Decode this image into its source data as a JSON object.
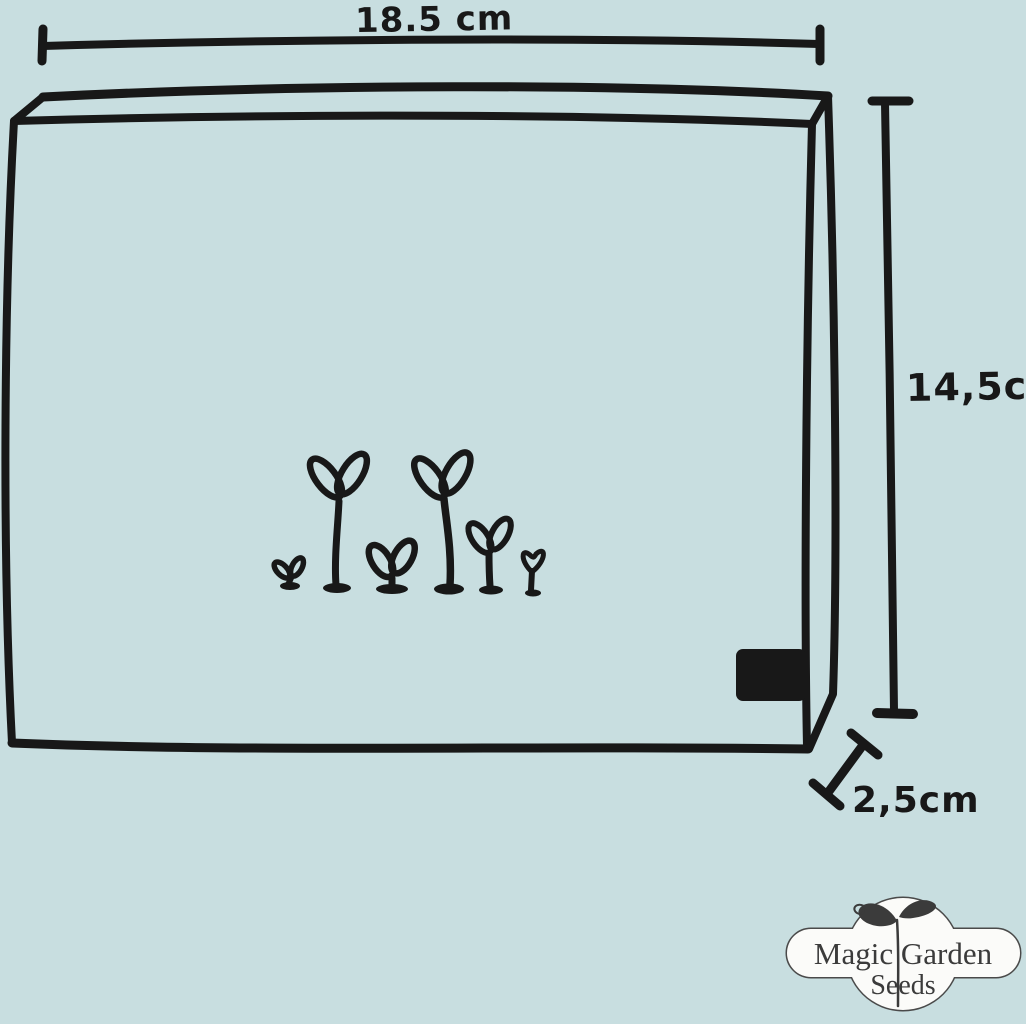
{
  "scene": {
    "background_color": "#c8dee0",
    "ink_color": "#181818",
    "logo_fill_color": "#fbfbf9",
    "logo_outline_color": "#4a4a4a",
    "logo_text_color": "#3b3b3b"
  },
  "diagram": {
    "width_label": "18.5 cm",
    "height_label": "14,5cm",
    "depth_label": "2,5cm"
  },
  "logo": {
    "line1": "Magic Garden",
    "line2": "Seeds"
  }
}
